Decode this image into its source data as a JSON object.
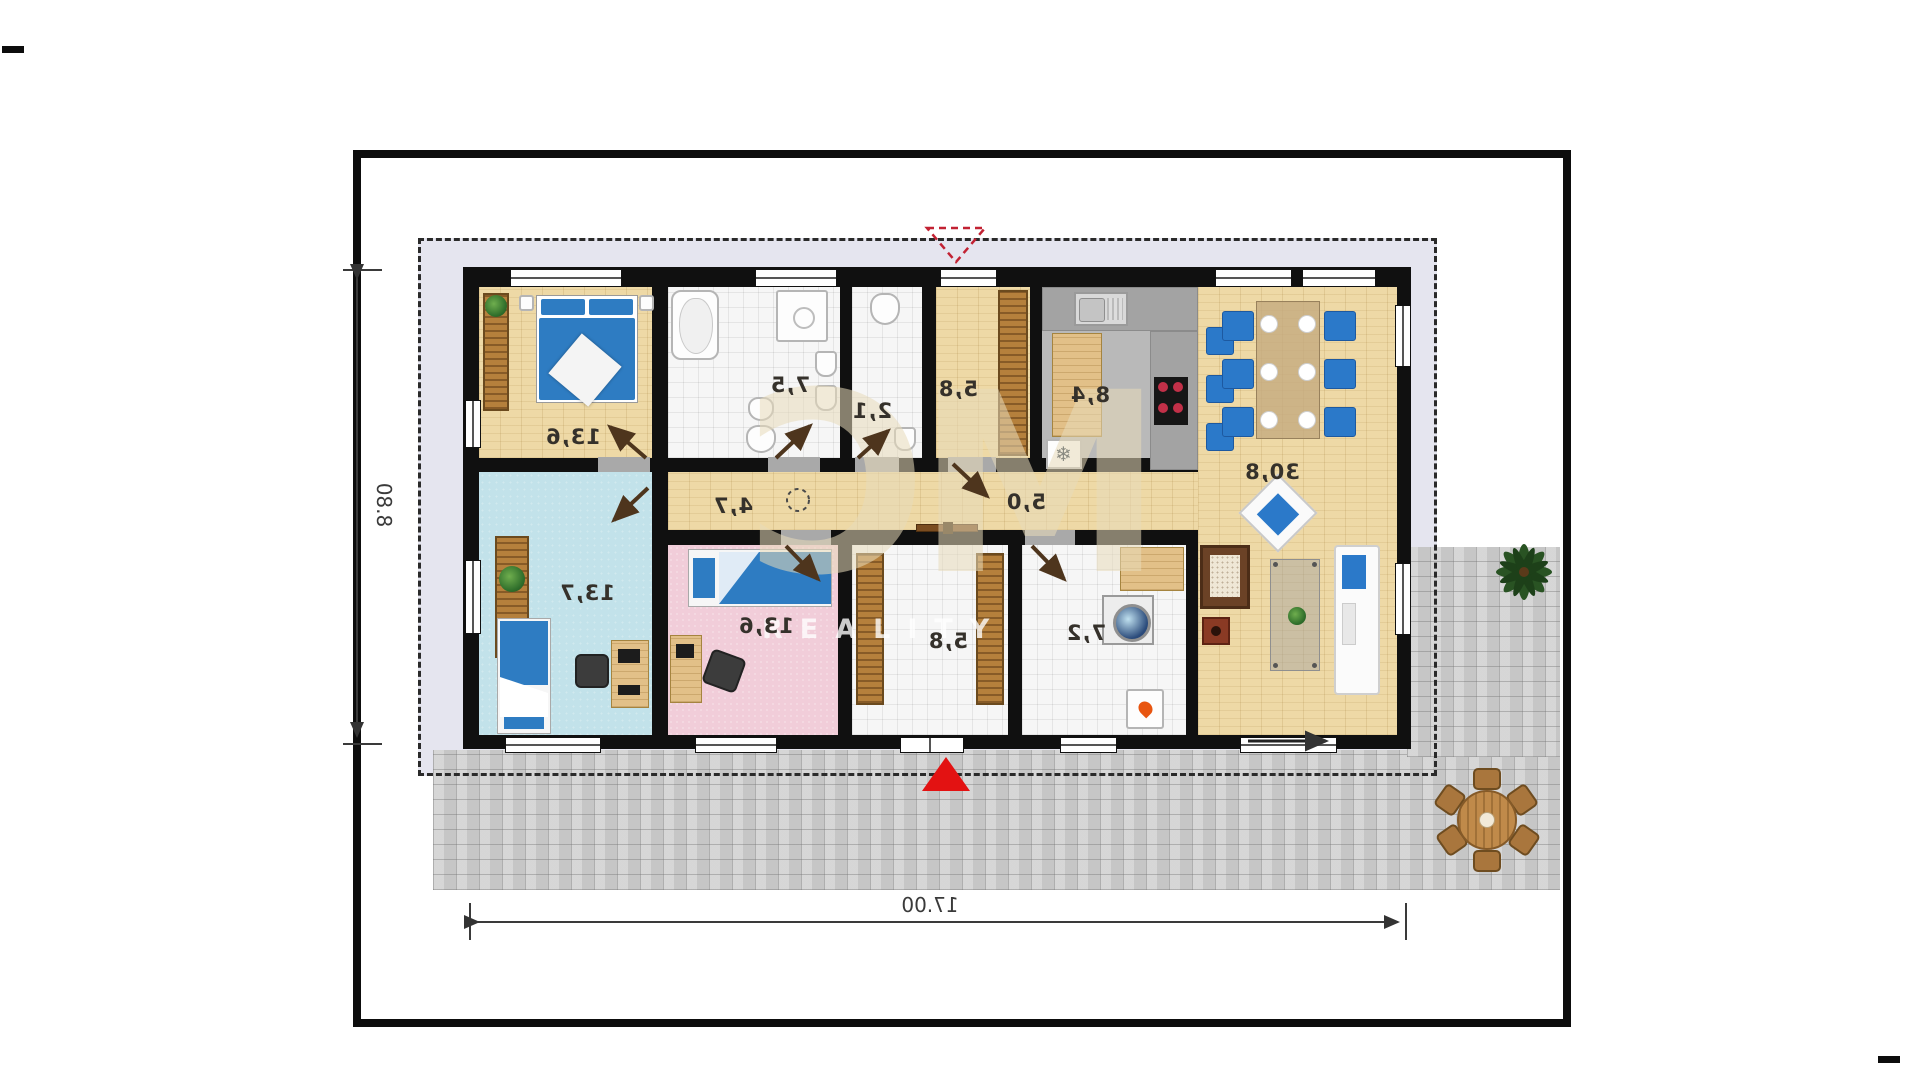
{
  "plan": {
    "type": "floor-plan",
    "mirrored": true,
    "watermark": {
      "logo": "MC",
      "text": "REALITY"
    },
    "dimensions": {
      "width_label": "17.00",
      "height_label": "8.80"
    },
    "rooms": [
      {
        "id": "bedroom-main",
        "area": "13,6"
      },
      {
        "id": "bathroom",
        "area": "7,5"
      },
      {
        "id": "wc",
        "area": "2,1"
      },
      {
        "id": "hall-top",
        "area": "5,8"
      },
      {
        "id": "kitchen",
        "area": "8,4"
      },
      {
        "id": "living-room",
        "area": "30,8"
      },
      {
        "id": "corridor",
        "area": "4,7"
      },
      {
        "id": "hallway",
        "area": "5,0"
      },
      {
        "id": "room-blue",
        "area": "13,7"
      },
      {
        "id": "room-pink",
        "area": "13,6"
      },
      {
        "id": "entrance-hall",
        "area": "5,8"
      },
      {
        "id": "utility-room",
        "area": "7,2"
      }
    ],
    "icons": {
      "fridge": "❄"
    },
    "colors": {
      "wall": "#101010",
      "wood_floor": "#eed9a6",
      "tile_floor": "#f6f6f6",
      "blue_room_floor": "#c2e2ea",
      "pink_room_floor": "#f1cdd9",
      "kitchen_floor": "#b9b9b9",
      "plot_surround": "#e5e5ef",
      "terrace": "#d2d2d2",
      "furniture_blue": "#2b79c9",
      "accent_red": "#e31212",
      "watermark_beige": "#e8dbba"
    }
  }
}
